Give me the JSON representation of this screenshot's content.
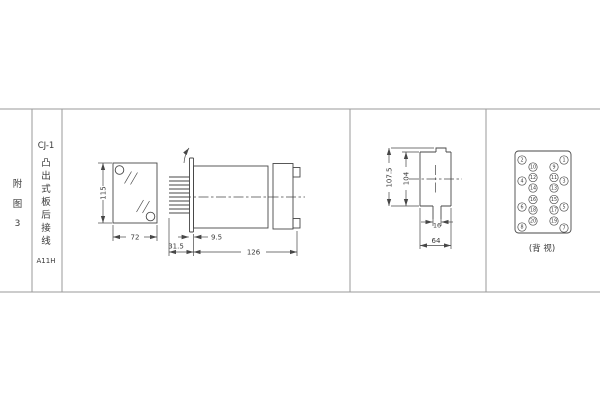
{
  "title_block": {
    "figure_label_chars": [
      "附",
      "图",
      "3"
    ],
    "model": "CJ-1",
    "mounting_desc_chars": [
      "凸",
      "出",
      "式",
      "板",
      "后",
      "接",
      "线"
    ],
    "code": "A11H"
  },
  "dimensions": {
    "panel_cutout_height": "115",
    "panel_cutout_width": "72",
    "pin_length": "31.5",
    "panel_thickness": "9.5",
    "body_length": "126",
    "rear_outer_height": "107.5",
    "rear_inner_height": "104",
    "key_slot_width": "16",
    "rear_width": "64"
  },
  "back_view": {
    "caption": "(背 视)",
    "terminals": {
      "outer_left": [
        "2",
        "4",
        "6",
        "8"
      ],
      "outer_right": [
        "1",
        "3",
        "5",
        "7"
      ],
      "inner_left": [
        "10",
        "12",
        "14",
        "16",
        "18",
        "20"
      ],
      "inner_right": [
        "9",
        "11",
        "13",
        "15",
        "17",
        "19"
      ]
    }
  },
  "colors": {
    "drawing_line": "#474747",
    "table_line": "#9a9a9a",
    "text": "#3a3a3a",
    "background": "#ffffff"
  }
}
